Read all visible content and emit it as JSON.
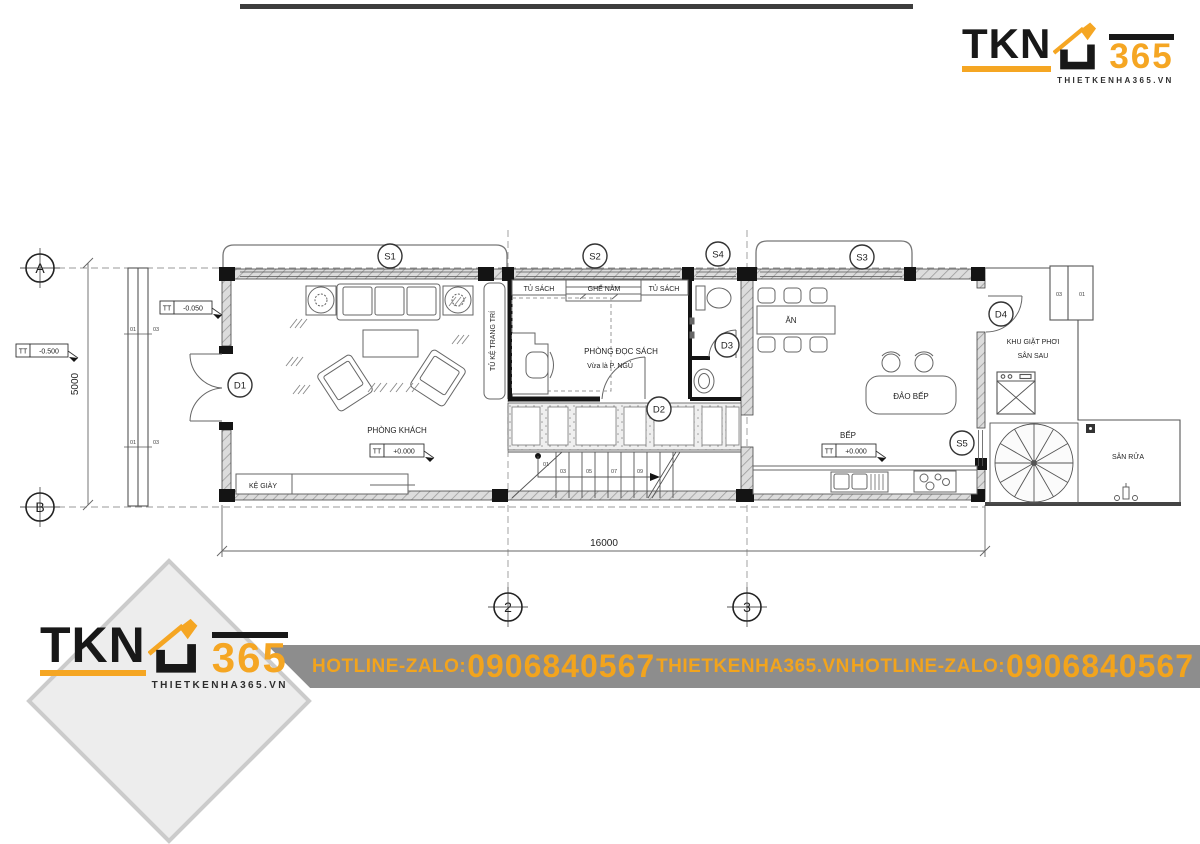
{
  "header": {
    "logo": {
      "name": "TKN",
      "num": "365",
      "tagline": "THIETKENHA365.VN"
    }
  },
  "footer": {
    "banner": {
      "bg": "#8d8d8d",
      "accent": "#f2a41d",
      "items": [
        "HOTLINE-ZALO:",
        "0906840567",
        "THIETKENHA365.VN",
        "HOTLINE-ZALO:",
        "0906840567"
      ]
    },
    "logo": {
      "name": "TKN",
      "num": "365",
      "tagline": "THIETKENHA365.VN"
    }
  },
  "plan": {
    "grid": {
      "rows": [
        "A",
        "B"
      ],
      "cols": [
        "2",
        "3"
      ]
    },
    "dimensions": {
      "height": "5000",
      "width": "16000"
    },
    "sections": [
      {
        "id": "S1"
      },
      {
        "id": "S2"
      },
      {
        "id": "S4"
      },
      {
        "id": "S3"
      },
      {
        "id": "S5"
      }
    ],
    "doors": [
      {
        "id": "D1"
      },
      {
        "id": "D2"
      },
      {
        "id": "D3"
      },
      {
        "id": "D4"
      }
    ],
    "levels": [
      {
        "prefix": "TT",
        "value": "-0.500"
      },
      {
        "prefix": "TT",
        "value": "-0.050"
      },
      {
        "prefix": "TT",
        "value": "+0.000"
      },
      {
        "prefix": "TT",
        "value": "+0.000"
      }
    ],
    "rooms": {
      "living": "PHÒNG KHÁCH",
      "shoe_shelf": "KỆ GIÀY",
      "deco_cabinet": "TỦ KỆ TRANG TRÍ",
      "bookshelf_left": "TỦ SÁCH",
      "daybed": "GHẾ NẰM",
      "bookshelf_right": "TỦ SÁCH",
      "reading": "PHÒNG ĐỌC SÁCH",
      "reading_sub": "Vừa là P. NGỦ",
      "dining": "ĂN",
      "island": "ĐẢO BẾP",
      "kitchen": "BẾP",
      "laundry_line1": "KHU GIẶT PHƠI",
      "laundry_line2": "SÂN SAU",
      "wash_yard": "SÂN RỬA"
    },
    "stairs": {
      "numbers": [
        "01",
        "03",
        "05",
        "07",
        "09"
      ]
    },
    "wall_tags": {
      "porch_top": [
        "01",
        "03"
      ],
      "porch_bottom": [
        "01",
        "03"
      ],
      "cabinet": [
        "03",
        "01"
      ]
    }
  }
}
